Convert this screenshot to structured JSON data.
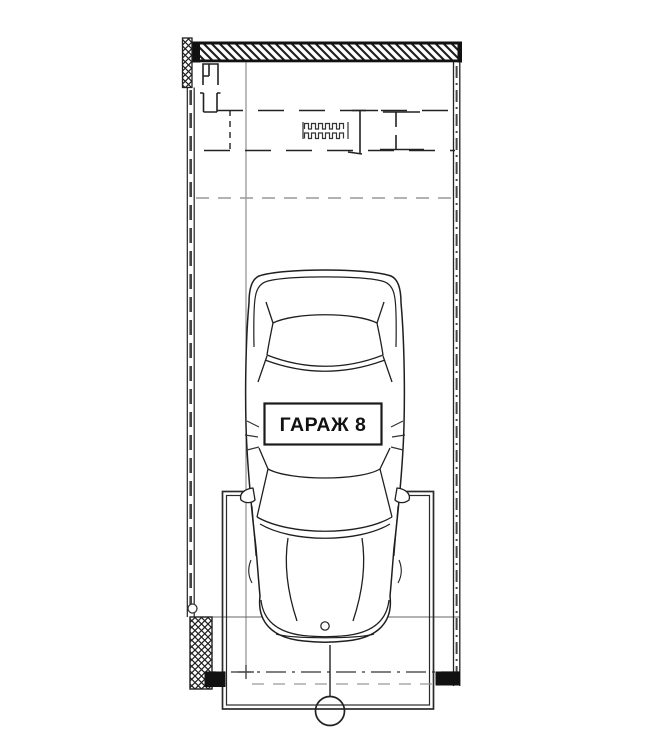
{
  "plan": {
    "room_label": "ГАРАЖ 8",
    "colors": {
      "ink": "#1f1f1f",
      "wall_black": "#111111",
      "mid_gray_line": "#666666",
      "light_gray_line": "#999999",
      "paper": "#ffffff"
    },
    "symbols": {
      "car": "car-top-view",
      "door_spring": "overhead-door-spring-symbol",
      "axis_marker": "axis-marker-circle",
      "walls": "hatched-masonry-wall",
      "piers": "cross-hatched-pier",
      "door_track": "overhead-door-track-dashed"
    }
  }
}
